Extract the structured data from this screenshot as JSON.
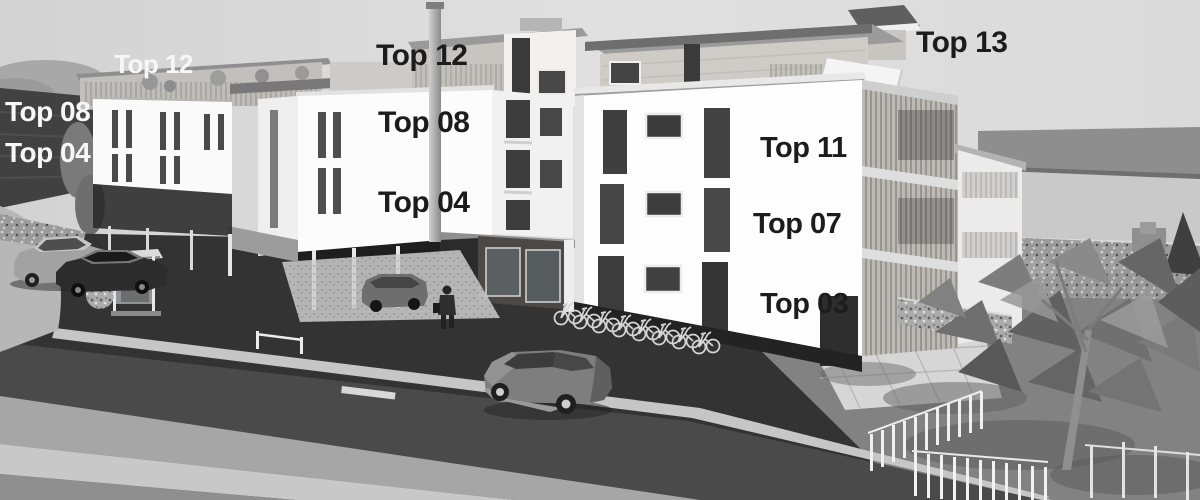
{
  "meta": {
    "title": "Grayscale 3D architectural rendering of a modern apartment complex with labelled units",
    "style": "black-and-white visualization, street-level perspective"
  },
  "unit_labels": [
    {
      "id": "unit-label-top-12-left",
      "text": "Top 12",
      "x": 114,
      "y": 51,
      "size": 26,
      "color": "#f7f7f7"
    },
    {
      "id": "unit-label-top-08-left",
      "text": "Top 08",
      "x": 5,
      "y": 98,
      "size": 28,
      "color": "#f7f7f7"
    },
    {
      "id": "unit-label-top-04-left",
      "text": "Top 04",
      "x": 5,
      "y": 139,
      "size": 28,
      "color": "#f7f7f7"
    },
    {
      "id": "unit-label-top-12-center",
      "text": "Top 12",
      "x": 376,
      "y": 41,
      "size": 30,
      "color": "#1c1c1c"
    },
    {
      "id": "unit-label-top-08-center",
      "text": "Top 08",
      "x": 378,
      "y": 108,
      "size": 30,
      "color": "#1c1c1c"
    },
    {
      "id": "unit-label-top-04-center",
      "text": "Top 04",
      "x": 378,
      "y": 188,
      "size": 30,
      "color": "#1c1c1c"
    },
    {
      "id": "unit-label-top-13",
      "text": "Top 13",
      "x": 916,
      "y": 28,
      "size": 30,
      "color": "#1c1c1c"
    },
    {
      "id": "unit-label-top-11",
      "text": "Top 11",
      "x": 760,
      "y": 134,
      "size": 29,
      "color": "#1c1c1c"
    },
    {
      "id": "unit-label-top-07",
      "text": "Top 07",
      "x": 753,
      "y": 210,
      "size": 29,
      "color": "#1c1c1c"
    },
    {
      "id": "unit-label-top-03",
      "text": "Top 03",
      "x": 760,
      "y": 290,
      "size": 29,
      "color": "#1c1c1c"
    }
  ],
  "palette": {
    "sky": "#dcdcdc",
    "facade_white": "#fbfbfb",
    "penthouse_gray": "#cbc8c4",
    "dark_wall": "#414141",
    "parking_asphalt": "#333333",
    "road": "#4a4a4a",
    "sidewalk_light": "#c6c6c6",
    "terrain_right": "#828282",
    "window_dark": "#3f3f3f",
    "label_dark": "#1c1c1c",
    "label_light": "#f7f7f7"
  },
  "scene_elements": [
    "left apartment wing on pilotis with narrow window slits",
    "center apartment building with rooftop terrace, flag pole / chimney and glass storefront",
    "right apartment building with three labelled floors and wooden-slat balcony tower",
    "penthouse level Top 13 with white canopy",
    "two parked cars and bus shelter on the left",
    "gray hatchback car on the foreground road",
    "pedestrian walking in front of the center building",
    "row of bicycles in a rack in front of the right building",
    "gabion stone wall, paved terrace and glass-post fence on the right",
    "low-poly trees and shrubs on the right side",
    "dark retaining wall on the far left"
  ]
}
